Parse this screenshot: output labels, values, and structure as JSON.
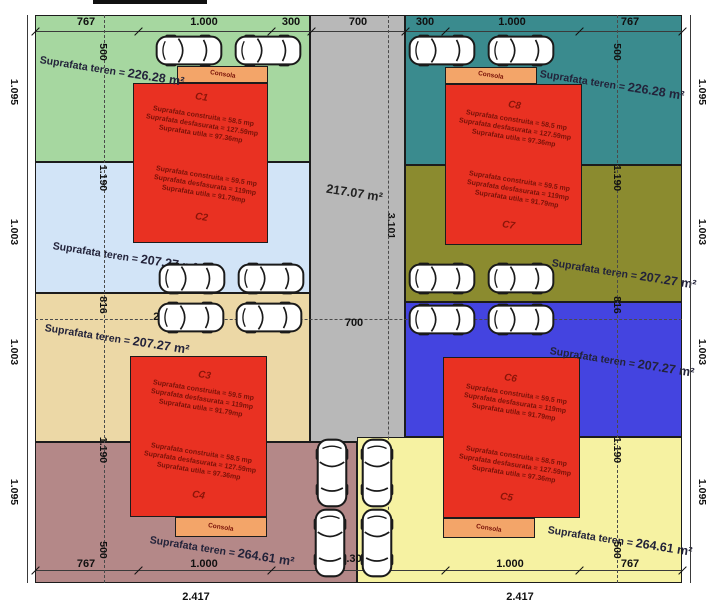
{
  "plan": {
    "consola": "Consola",
    "road": {
      "area_label": "217.07 m²",
      "length_label": "3.101"
    },
    "parcels": {
      "green": {
        "teren_prefix": "Suprafata teren = ",
        "teren_value": "226.28 m²"
      },
      "teal": {
        "teren_prefix": "Suprafata teren = ",
        "teren_value": "226.28 m²"
      },
      "lightblue": {
        "teren_prefix": "Suprafata teren = ",
        "teren_value": "207.27 m²"
      },
      "olive": {
        "teren_prefix": "Suprafata teren = ",
        "teren_value": "207.27 m²"
      },
      "tan": {
        "teren_prefix": "Suprafata teren = ",
        "teren_value": "207.27 m²"
      },
      "blue": {
        "teren_prefix": "Suprafata teren = ",
        "teren_value": "207.27 m²"
      },
      "mauve": {
        "teren_prefix": "Suprafata teren = ",
        "teren_value": "264.61 m²"
      },
      "yellow": {
        "teren_prefix": "Suprafata teren = ",
        "teren_value": "264.61 m²"
      }
    },
    "houses": {
      "c1": {
        "label": "C1",
        "construita": "Suprafata construita = 58.5 mp",
        "desfasurata": "Suprafata desfasurata = 127.59mp",
        "utila": "Suprafata utila = 97.36mp"
      },
      "c2": {
        "label": "C2",
        "construita": "Suprafata construita = 59.5 mp",
        "desfasurata": "Suprafata desfasurata = 119mp",
        "utila": "Suprafata utila = 91.79mp"
      },
      "c3": {
        "label": "C3",
        "construita": "Suprafata construita = 59.5 mp",
        "desfasurata": "Suprafata desfasurata = 119mp",
        "utila": "Suprafata utila = 91.79mp"
      },
      "c4": {
        "label": "C4",
        "construita": "Suprafata construita = 58.5 mp",
        "desfasurata": "Suprafata desfasurata = 127.59mp",
        "utila": "Suprafata utila = 97.36mp"
      },
      "c5": {
        "label": "C5",
        "construita": "Suprafata construita = 58.5 mp",
        "desfasurata": "Suprafata desfasurata = 127.59mp",
        "utila": "Suprafata utila = 97.36mp"
      },
      "c6": {
        "label": "C6",
        "construita": "Suprafata construita = 59.5 mp",
        "desfasurata": "Suprafata desfasurata = 119mp",
        "utila": "Suprafata utila = 91.79mp"
      },
      "c7": {
        "label": "C7",
        "construita": "Suprafata construita = 59.5 mp",
        "desfasurata": "Suprafata desfasurata = 119mp",
        "utila": "Suprafata utila = 91.79mp"
      },
      "c8": {
        "label": "C8",
        "construita": "Suprafata construita = 58.5 mp",
        "desfasurata": "Suprafata desfasurata = 127.59mp",
        "utila": "Suprafata utila = 97.36mp"
      }
    },
    "dims": {
      "top": [
        "767",
        "1.000",
        "300",
        "700",
        "300",
        "1.000",
        "767"
      ],
      "parking_left": "2.047",
      "parking_mid": "700",
      "parking_right": "2.067",
      "bottom": [
        "767",
        "1.000",
        "1.300",
        "1.000",
        "767"
      ],
      "totals": [
        "2.417",
        "2.417"
      ],
      "left_outer": [
        "1.095",
        "1.003",
        "1.003",
        "1.095"
      ],
      "right_outer": [
        "1.095",
        "1.003",
        "1.003",
        "1.095"
      ],
      "left_inner": [
        "500",
        "1.190",
        "816",
        "1.190",
        "500"
      ],
      "right_inner": [
        "500",
        "1.190",
        "816",
        "1.190",
        "500"
      ]
    },
    "colors": {
      "green": "#a6d7a0",
      "teal": "#3a8b8e",
      "lightblue": "#d2e4f7",
      "olive": "#8b8b2f",
      "tan": "#ecd8a6",
      "blue": "#4444e0",
      "mauve": "#b48888",
      "yellow": "#f6f2a2",
      "road": "#b8b8b8",
      "house": "#e93122",
      "consola": "#f3a569"
    }
  }
}
